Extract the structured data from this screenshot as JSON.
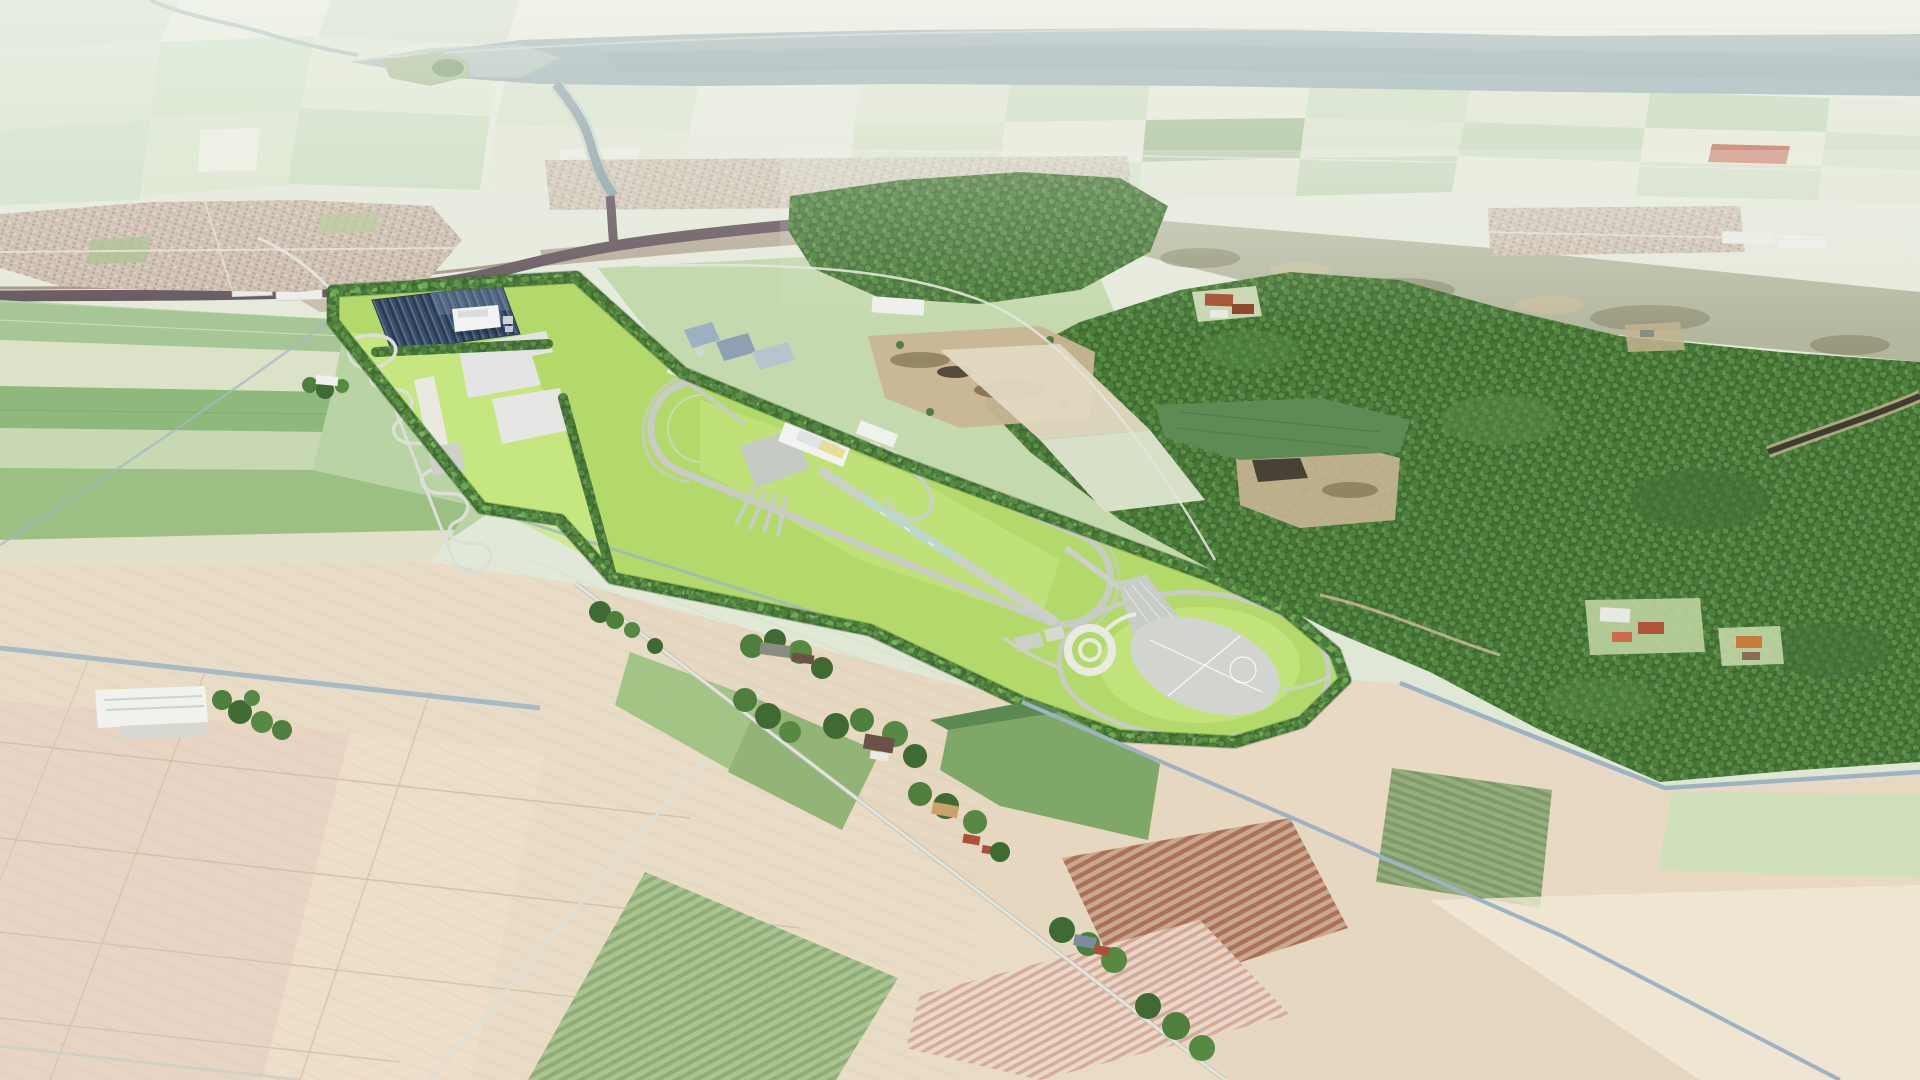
{
  "meta": {
    "type": "aerial-render",
    "description": "Aerial artist impression of an elongated automotive proving ground with solar farm, handling course, oval track, technical center, braking straight, skid circle and circular dynamic platform, set in a flat agricultural polder landscape with a wide estuary, a dark winding river, two towns, a large forest and geometric beige farm fields in the foreground."
  },
  "palette": {
    "haze_top": "#f3f5ee",
    "bg_top": "#e7ebdf",
    "bg_mid": "#dfe7d4",
    "estuary_water": "#8ba3ab",
    "estuary_deep": "#7e96a0",
    "island_green": "#9cb287",
    "river_dark": "#52404b",
    "river_pond": "#4a3a44",
    "river_bank": "#7c5e4e",
    "mud_flat": "#7b5c4a",
    "marsh_olive": "#a5aa8c",
    "town_base": "#c6b4a6",
    "forest_dark": "#3f6b33",
    "forest_mid": "#4e7f3d",
    "forest_light": "#64984c",
    "clearing_sand": "#c9b593",
    "strip_green": "#c5d9ae",
    "facility_green": "#b4d96b",
    "facility_green_light": "#cbe886",
    "hedge_green": "#4c7c3a",
    "track_gray": "#c8ccc4",
    "track_light": "#dcdfd7",
    "line_white": "#eceee6",
    "pad_gray": "#d2d5cf",
    "pad_white": "#e7e4ea",
    "solar_dark": "#3a4e6a",
    "building_white": "#f2f3f0",
    "roof_yellow": "#e5dd8e",
    "canal_blue": "#9fb5c6",
    "field_beige": "#e9dcc6",
    "field_beige2": "#e6d8c0",
    "field_beige3": "#ead9c2",
    "field_pink": "#e8d2c2",
    "field_cream": "#eeddc8",
    "crop_green": "#7fa768",
    "crop_green_dark": "#5c8852",
    "crop_green_bright": "#9ec383",
    "pale_green_field": "#cfe0bb",
    "dark_row_field": "#5e8a54",
    "red_field": "#bd5742",
    "farm_roof_red": "#b05038",
    "farm_roof_dark": "#6b5148",
    "farm_roof_orange": "#c97a3e",
    "shed_blue": "#8fa0b5",
    "road_light": "#e3e4dc",
    "braking_teal": "#b9d8ce"
  },
  "scene": {
    "landmarks": [
      "estuary",
      "tidal-island",
      "dark-river",
      "left-town",
      "right-village",
      "heath-marsh-band",
      "large-forest",
      "sandy-clearings",
      "forest-creek",
      "proving-ground",
      "solar-farm",
      "workshop-building",
      "white-test-pads",
      "handling-course",
      "oval-track",
      "technical-center",
      "garage-fingers",
      "braking-straight",
      "skid-circle",
      "dynamic-platform",
      "roundabout-fan",
      "perimeter-hedgerows",
      "boundary-canals",
      "tree-lined-road",
      "farmsteads",
      "orchard-rows",
      "beige-polder-fields",
      "warehouse"
    ]
  }
}
